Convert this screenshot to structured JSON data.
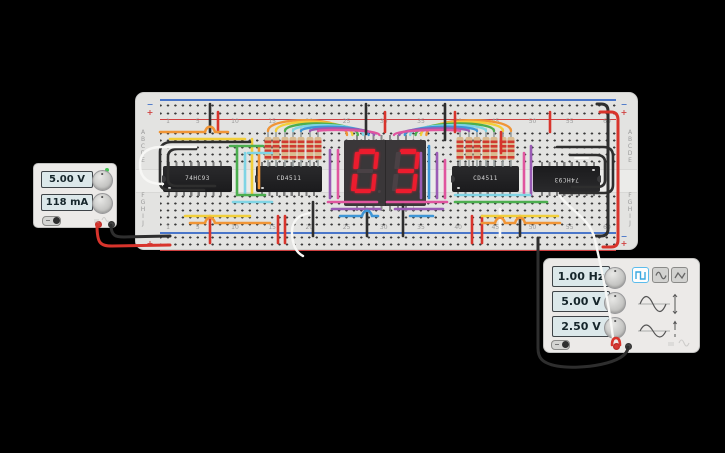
{
  "app_background": "#000000",
  "power_supply": {
    "voltage": "5.00 V",
    "current": "118 mA",
    "power_led_color": "#43c553"
  },
  "breadboard": {
    "column_numbers": [
      "1",
      "5",
      "10",
      "15",
      "20",
      "25",
      "30",
      "35",
      "40",
      "45",
      "50",
      "55",
      "60"
    ],
    "row_letters": [
      "A",
      "B",
      "C",
      "D",
      "E",
      "F",
      "G",
      "H",
      "I",
      "J"
    ],
    "plus_symbol": "+",
    "minus_symbol": "−",
    "plus_rail_color": "#cf4040",
    "minus_rail_color": "#4a76c9"
  },
  "ics": [
    {
      "label": "74HC93"
    },
    {
      "label": "CD4511"
    },
    {
      "label": "CD4511"
    },
    {
      "label": "74HC93"
    }
  ],
  "seven_segment": {
    "value": "03",
    "lit_color": "#ec1c2e",
    "unlit_color": "#4a4145",
    "body_color": "#3a3739"
  },
  "function_generator": {
    "frequency": "1.00 Hz",
    "amplitude": "5.00 V",
    "offset": "2.50 V",
    "waveforms": [
      "square",
      "sine",
      "triangle"
    ],
    "selected_waveform": "square",
    "selected_color": "#5bbcec"
  },
  "wire_palette": {
    "orange": "#f09536",
    "yellow": "#f2cf3a",
    "green": "#4cae4f",
    "cyan": "#7fd4e4",
    "blue": "#3e95d6",
    "purple": "#9a5bb5",
    "magenta": "#e0559f",
    "red": "#d8342c",
    "black": "#2e2e2e",
    "white": "#f7f7f5",
    "lead": "#9aa0a0",
    "resistor_body": "#d9bb90",
    "resistor_band": "#d03a30"
  }
}
